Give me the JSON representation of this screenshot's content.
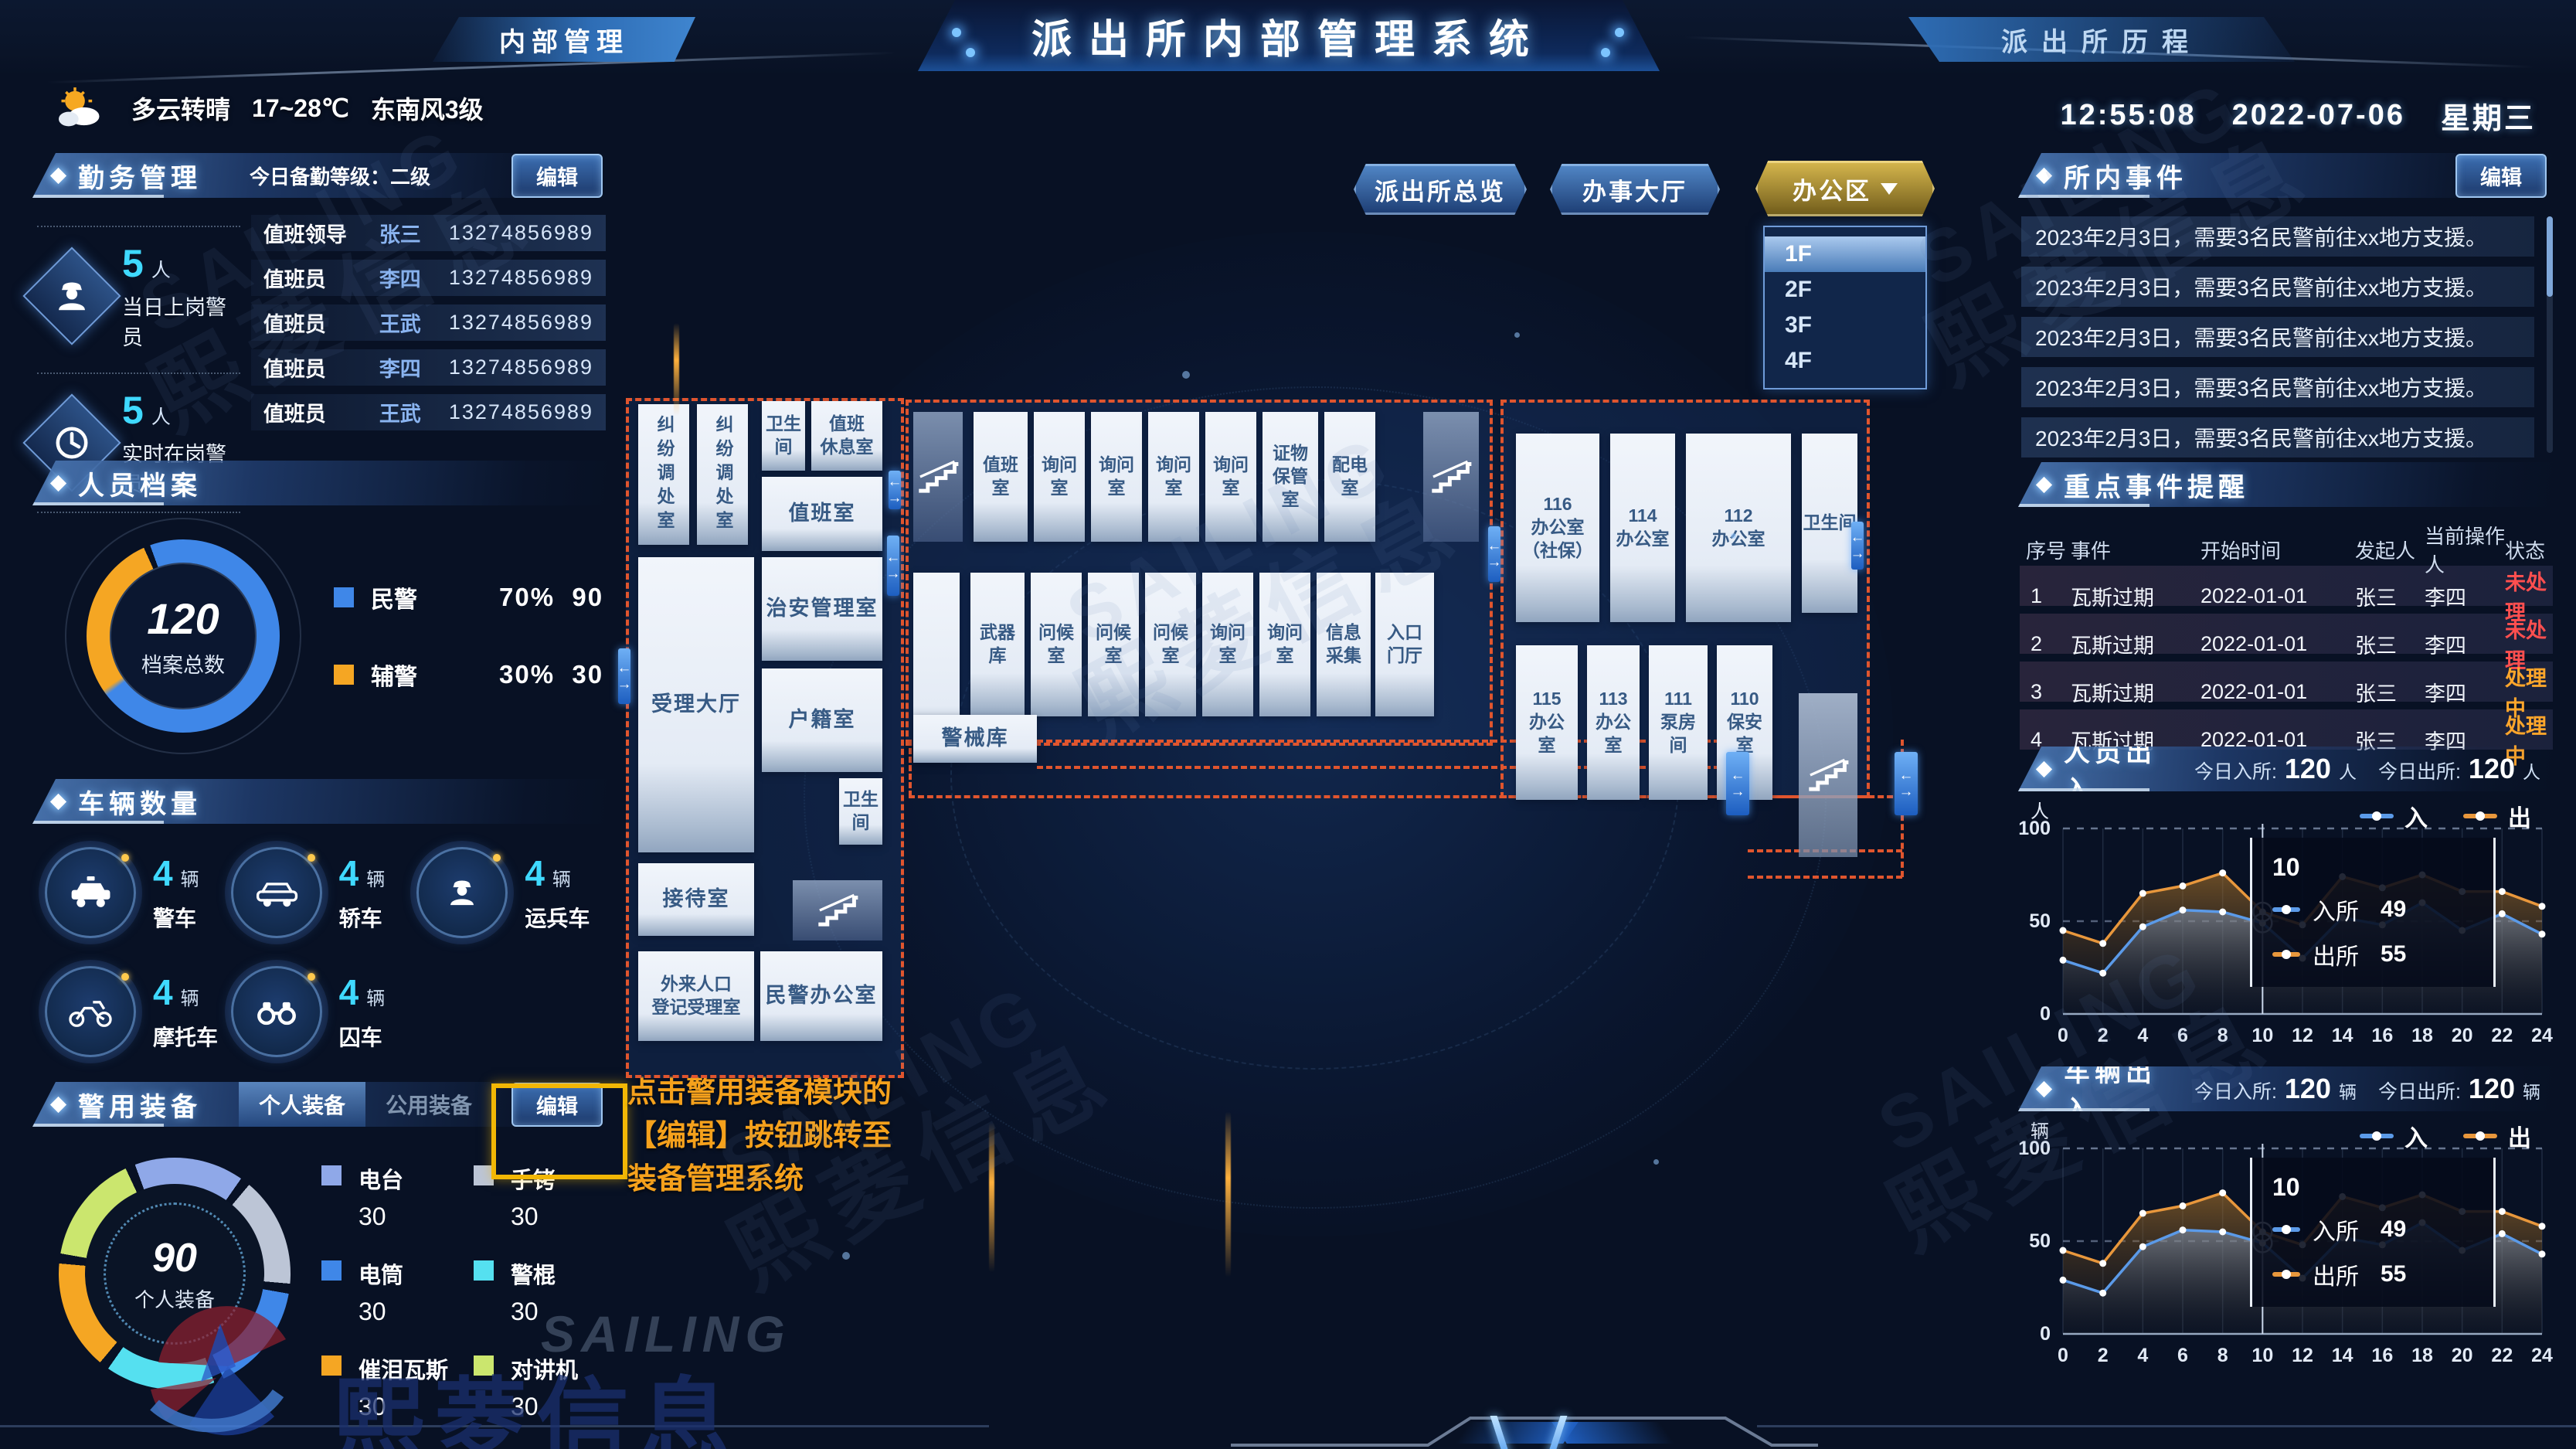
{
  "header": {
    "title": "派出所内部管理系统",
    "left_tab": "内部管理",
    "right_tab": "派出所历程",
    "weather": {
      "condition": "多云转晴",
      "temp": "17~28℃",
      "wind": "东南风3级"
    },
    "clock": {
      "time": "12:55:08",
      "date": "2022-07-06",
      "weekday": "星期三"
    }
  },
  "view_buttons": {
    "overview": "派出所总览",
    "hall": "办事大厅",
    "office": "办公区"
  },
  "floor_dropdown": {
    "options": [
      "1F",
      "2F",
      "3F",
      "4F"
    ],
    "selected": "1F"
  },
  "duty": {
    "title": "勤务管理",
    "level_label": "今日备勤等级：二级",
    "edit_label": "编辑",
    "stats": [
      {
        "value": "5",
        "unit": "人",
        "label": "当日上岗警员",
        "icon": "officer-icon"
      },
      {
        "value": "5",
        "unit": "人",
        "label": "实时在岗警员",
        "icon": "clock-icon"
      }
    ],
    "roster": [
      {
        "role": "值班领导",
        "name": "张三",
        "phone": "13274856989"
      },
      {
        "role": "值班员",
        "name": "李四",
        "phone": "13274856989"
      },
      {
        "role": "值班员",
        "name": "王武",
        "phone": "13274856989"
      },
      {
        "role": "值班员",
        "name": "李四",
        "phone": "13274856989"
      },
      {
        "role": "值班员",
        "name": "王武",
        "phone": "13274856989"
      }
    ]
  },
  "personnel": {
    "title": "人员档案",
    "total": "120",
    "total_label": "档案总数",
    "legend": [
      {
        "label": "民警",
        "percent": "70%",
        "count": "90",
        "color": "#3f87e8"
      },
      {
        "label": "辅警",
        "percent": "30%",
        "count": "30",
        "color": "#f5a623"
      }
    ]
  },
  "vehicles": {
    "title": "车辆数量",
    "items": [
      {
        "label": "警车",
        "count": "4",
        "unit": "辆",
        "icon": "police-car-icon"
      },
      {
        "label": "轿车",
        "count": "4",
        "unit": "辆",
        "icon": "car-icon"
      },
      {
        "label": "运兵车",
        "count": "4",
        "unit": "辆",
        "icon": "troop-carrier-icon"
      },
      {
        "label": "摩托车",
        "count": "4",
        "unit": "辆",
        "icon": "motorcycle-icon"
      },
      {
        "label": "囚车",
        "count": "4",
        "unit": "辆",
        "icon": "handcuffs-icon"
      }
    ]
  },
  "equipment": {
    "title": "警用装备",
    "tab_personal": "个人装备",
    "tab_public": "公用装备",
    "edit_label": "编辑",
    "total": "90",
    "total_label": "个人装备",
    "items": [
      {
        "label": "电台",
        "count": "30",
        "color": "#8fa8e8"
      },
      {
        "label": "手铐",
        "count": "30",
        "color": "#bcc5d6"
      },
      {
        "label": "电筒",
        "count": "30",
        "color": "#3f87e8"
      },
      {
        "label": "警棍",
        "count": "30",
        "color": "#55e0f0"
      },
      {
        "label": "催泪瓦斯",
        "count": "30",
        "color": "#f5a623"
      },
      {
        "label": "对讲机",
        "count": "30",
        "color": "#cbe66e"
      }
    ]
  },
  "annotation": {
    "text": "点击警用装备模块的\n【编辑】按钮跳转至\n装备管理系统"
  },
  "floorplan": {
    "left_rooms": [
      "纠纷调处室",
      "纠纷调处室",
      "卫生\n间",
      "值班\n休息室",
      "值班室",
      "受理大厅",
      "治安管理室",
      "户籍室",
      "卫生\n间",
      "接待室",
      "外来人口\n登记受理室",
      "民警办公室"
    ],
    "middle_rooms": [
      "值班\n室",
      "询问\n室",
      "询问\n室",
      "询问\n室",
      "询问\n室",
      "证物\n保管\n室",
      "配电\n室",
      "武器\n库",
      "问候\n室",
      "问候\n室",
      "问候\n室",
      "询问\n室",
      "询问\n室",
      "信息\n采集",
      "入口\n门厅",
      "警械库"
    ],
    "right_rooms": [
      "116\n办公室\n（社保）",
      "114\n办公室",
      "112\n办公室",
      "卫生间",
      "115\n办公\n室",
      "113\n办公\n室",
      "111\n泵房\n间",
      "110\n保安\n室"
    ]
  },
  "events": {
    "title": "所内事件",
    "edit_label": "编辑",
    "rows": [
      "2023年2月3日，需要3名民警前往xx地方支援。",
      "2023年2月3日，需要3名民警前往xx地方支援。",
      "2023年2月3日，需要3名民警前往xx地方支援。",
      "2023年2月3日，需要3名民警前往xx地方支援。",
      "2023年2月3日，需要3名民警前往xx地方支援。"
    ]
  },
  "reminders": {
    "title": "重点事件提醒",
    "columns": [
      "序号",
      "事件",
      "开始时间",
      "发起人",
      "当前操作人",
      "状态"
    ],
    "rows": [
      {
        "no": "1",
        "event": "瓦斯过期",
        "start": "2022-01-01",
        "initiator": "张三",
        "operator": "李四",
        "status": "未处理",
        "status_color": "#ff4f4f"
      },
      {
        "no": "2",
        "event": "瓦斯过期",
        "start": "2022-01-01",
        "initiator": "张三",
        "operator": "李四",
        "status": "未处理",
        "status_color": "#ff4f4f"
      },
      {
        "no": "3",
        "event": "瓦斯过期",
        "start": "2022-01-01",
        "initiator": "张三",
        "operator": "李四",
        "status": "处理中",
        "status_color": "#ffa62b"
      },
      {
        "no": "4",
        "event": "瓦斯过期",
        "start": "2022-01-01",
        "initiator": "张三",
        "operator": "李四",
        "status": "处理中",
        "status_color": "#ffa62b"
      }
    ]
  },
  "charts": [
    {
      "title": "人员出入",
      "in_label": "今日入所:",
      "in_value": "120",
      "in_unit": "人",
      "out_label": "今日出所:",
      "out_value": "120",
      "out_unit": "人",
      "legend_in": "入",
      "legend_out": "出",
      "tooltip": {
        "x": "10",
        "rows": [
          {
            "label": "入所",
            "value": "49",
            "color": "#5b9ae8"
          },
          {
            "label": "出所",
            "value": "55",
            "color": "#e8973c"
          }
        ]
      },
      "chart_data": {
        "type": "area",
        "x": [
          0,
          2,
          4,
          6,
          8,
          10,
          12,
          14,
          16,
          18,
          20,
          22,
          24
        ],
        "series": [
          {
            "name": "入",
            "color": "#5b9ae8",
            "values": [
              29,
              22,
              47,
              56,
              55,
              49,
              30,
              52,
              48,
              60,
              45,
              54,
              43
            ]
          },
          {
            "name": "出",
            "color": "#e8973c",
            "values": [
              45,
              38,
              65,
              69,
              76,
              55,
              48,
              74,
              68,
              75,
              66,
              66,
              58
            ]
          }
        ],
        "ylim": [
          0,
          100
        ],
        "ylabel": "人",
        "grid": "dashed",
        "legend_position": "top-right"
      }
    },
    {
      "title": "车辆出入",
      "in_label": "今日入所:",
      "in_value": "120",
      "in_unit": "辆",
      "out_label": "今日出所:",
      "out_value": "120",
      "out_unit": "辆",
      "legend_in": "入",
      "legend_out": "出",
      "tooltip": {
        "x": "10",
        "rows": [
          {
            "label": "入所",
            "value": "49",
            "color": "#5b9ae8"
          },
          {
            "label": "出所",
            "value": "55",
            "color": "#e8973c"
          }
        ]
      },
      "chart_data": {
        "type": "area",
        "x": [
          0,
          2,
          4,
          6,
          8,
          10,
          12,
          14,
          16,
          18,
          20,
          22,
          24
        ],
        "series": [
          {
            "name": "入",
            "color": "#5b9ae8",
            "values": [
              29,
              22,
              47,
              56,
              55,
              49,
              30,
              52,
              48,
              60,
              45,
              54,
              43
            ]
          },
          {
            "name": "出",
            "color": "#e8973c",
            "values": [
              45,
              38,
              65,
              69,
              76,
              55,
              48,
              74,
              68,
              75,
              66,
              66,
              58
            ]
          }
        ],
        "ylim": [
          0,
          100
        ],
        "ylabel": "辆",
        "grid": "dashed",
        "legend_position": "top-right"
      }
    }
  ],
  "watermark": {
    "line1": "SAILING",
    "line2": "熙菱信息"
  }
}
